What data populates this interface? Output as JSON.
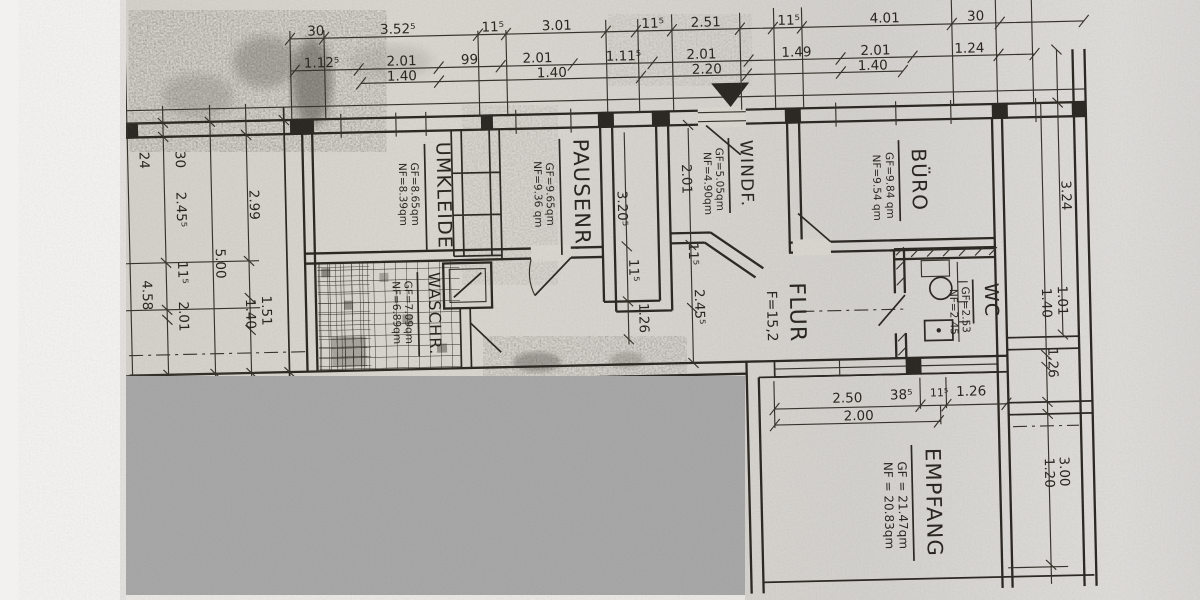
{
  "rooms": {
    "umkleide": {
      "name": "UMKLEIDE",
      "gf": "GF=8.65qm",
      "nf": "NF=8.39qm"
    },
    "pausenr": {
      "name": "PAUSENR.",
      "gf": "GF=9.65qm",
      "nf": "NF=9.36 qm"
    },
    "windf": {
      "name": "WINDF.",
      "gf": "GF=5.05qm",
      "nf": "NF=4.90qm"
    },
    "buero": {
      "name": "BÜRO",
      "gf": "GF=9.84 qm",
      "nf": "NF=9.54 qm"
    },
    "waschr": {
      "name": "WASCHR.",
      "gf": "GF=7.09qm",
      "nf": "NF=6.89qm"
    },
    "flur": {
      "name": "FLUR",
      "area": "F=15,2"
    },
    "wc": {
      "name": "WC",
      "gf": "GF=2.53",
      "nf": "NF=2.45"
    },
    "empfang": {
      "name": "EMPFANG",
      "gf": "GF = 21.47qm",
      "nf": "NF = 20.83qm"
    }
  },
  "dimensions": {
    "top_row1": [
      "30",
      "3.52⁵",
      "11⁵",
      "3.01",
      "11⁵",
      "2.51",
      "11⁵",
      "4.01",
      "30"
    ],
    "top_row2": [
      "1.12⁵",
      "2.01",
      "99",
      "2.01",
      "1.11⁵",
      "2.01",
      "1.49",
      "2.01",
      "1.24"
    ],
    "top_row3": [
      "1.40",
      "1.40",
      "2.20",
      "1.40"
    ],
    "left_col1": [
      "24",
      "4.58"
    ],
    "left_col2": [
      "30",
      "2.45⁵",
      "11⁵",
      "2.01"
    ],
    "left_col3": [
      "5.00"
    ],
    "left_col4": [
      "2.99",
      "1.51",
      "1.40"
    ],
    "mid_col1": [
      "3.20⁵",
      "11⁵",
      "1.26"
    ],
    "mid_col2": [
      "2.01",
      "11⁵",
      "2.45⁵"
    ],
    "right_col": [
      "3.24",
      "1.01",
      "1.40",
      "1.26",
      "3.00",
      "1.20"
    ],
    "empfang_row1": [
      "2.50",
      "38⁵",
      "11⁵",
      "1.26"
    ],
    "empfang_row2": [
      "2.00"
    ]
  }
}
